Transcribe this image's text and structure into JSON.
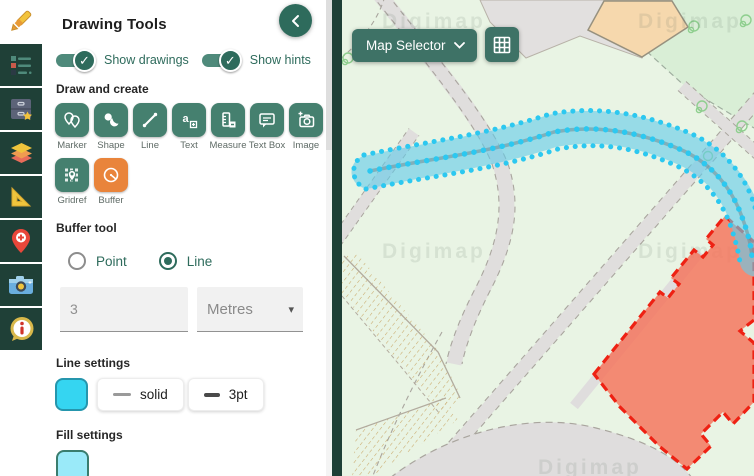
{
  "glyphs": {
    "check": "✓",
    "caret": "▾"
  },
  "colors": {
    "sidebar_bg": "#1f4037",
    "accent_teal": "#2e6b5c",
    "tool_button": "#45806f",
    "selected_tool_orange": "#e9843b",
    "line_color": "#35d5f1",
    "fill_color": "#9aeaf9",
    "buffer_cyan": "#5ecbe8",
    "selected_area_red": "#f7644a"
  },
  "sidebar": {
    "items": [
      {
        "icon": "crayon-icon",
        "active": true
      },
      {
        "icon": "legend-list-icon",
        "active": false
      },
      {
        "icon": "drawers-star-icon",
        "active": false
      },
      {
        "icon": "layers-icon",
        "active": false
      },
      {
        "icon": "set-square-icon",
        "active": false
      },
      {
        "icon": "map-pin-plus-icon",
        "active": false
      },
      {
        "icon": "camera-icon",
        "active": false
      },
      {
        "icon": "info-bubble-icon",
        "active": false
      }
    ]
  },
  "panel": {
    "title": "Drawing Tools",
    "collapse_icon": "chevron-left-icon",
    "toggles": [
      {
        "label": "Show drawings",
        "state": "on"
      },
      {
        "label": "Show hints",
        "state": "on"
      }
    ],
    "draw_and_create": {
      "heading": "Draw and create",
      "tools": [
        {
          "label": "Marker"
        },
        {
          "label": "Shape"
        },
        {
          "label": "Line"
        },
        {
          "label": "Text",
          "icon_glyph": "a"
        },
        {
          "label": "Measure"
        },
        {
          "label": "Text Box"
        },
        {
          "label": "Image"
        },
        {
          "label": "Gridref"
        },
        {
          "label": "Buffer",
          "selected": true
        }
      ]
    },
    "buffer_tool": {
      "heading": "Buffer tool",
      "options": [
        {
          "label": "Point",
          "selected": false
        },
        {
          "label": "Line",
          "selected": true
        }
      ],
      "distance_value": "3",
      "unit_value": "Metres"
    },
    "line_settings": {
      "heading": "Line settings",
      "style_label": "solid",
      "width_label": "3pt"
    },
    "fill_settings": {
      "heading": "Fill settings"
    }
  },
  "map": {
    "selector_label": "Map Selector",
    "watermark_text": "Digimap"
  }
}
